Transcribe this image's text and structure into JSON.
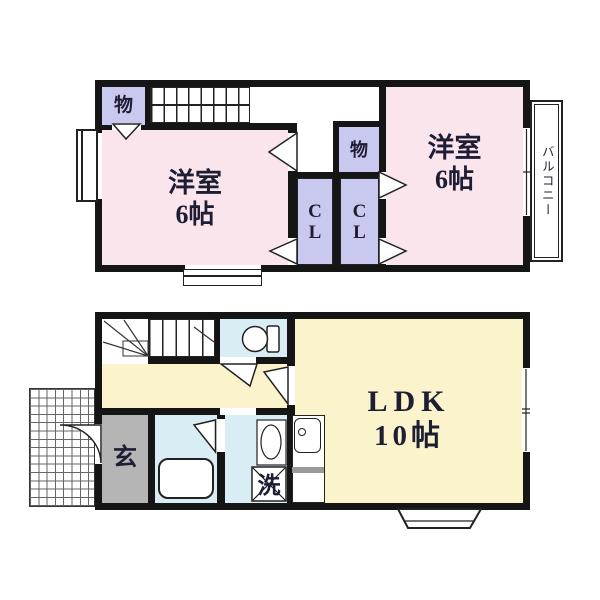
{
  "document_type": "japanese-apartment-floor-plan",
  "colors": {
    "wall": "#151515",
    "room_pink": "#fbe5ed",
    "closet_lavender": "#c9c8ef",
    "hall_yellow": "#faf3cb",
    "water_blue": "#d9edf5",
    "entrance_gray": "#b5b5b5",
    "label_ink": "#1d1d33"
  },
  "second_floor": {
    "west_room": {
      "name": "洋室",
      "size": "6帖"
    },
    "east_room": {
      "name": "洋室",
      "size": "6帖"
    },
    "west_storage_label": "物",
    "east_storage_label": "物",
    "west_closet_label": "CL",
    "east_closet_label": "CL",
    "balcony_label": "バルコニー"
  },
  "first_floor": {
    "ldk": {
      "name": "LDK",
      "size": "10帖"
    },
    "entrance_label": "玄",
    "laundry_label": "洗"
  }
}
